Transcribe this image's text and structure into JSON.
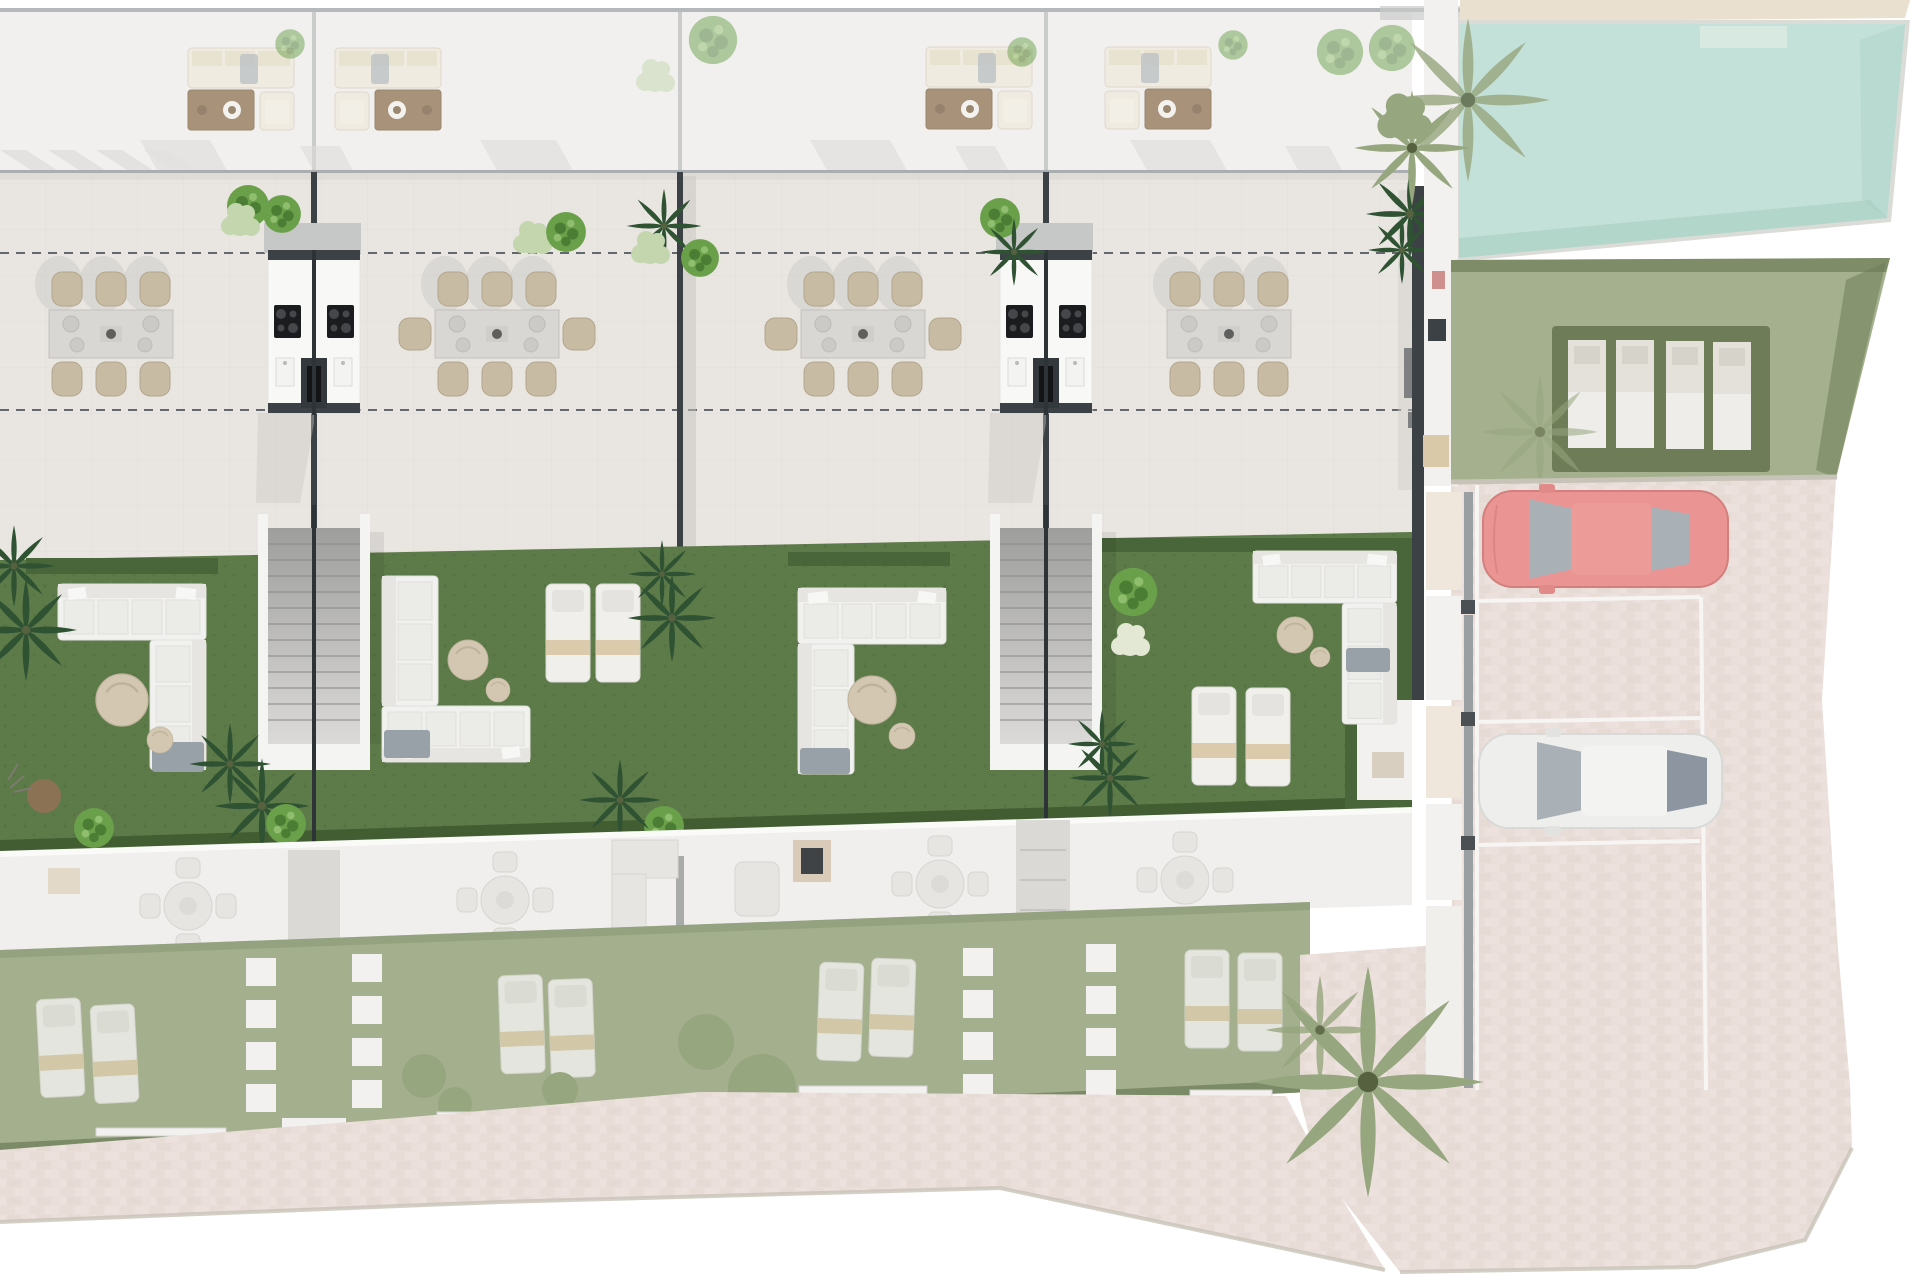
{
  "meta": {
    "title": "Residential development site plan - top view 3D rendering",
    "description": "Top-down architectural rendering of four terraced townhouse units with roof terraces, outdoor kitchens, staircases, private gardens, communal pool, sun-lounger lawn and parking with two cars. Featured floor shown saturated, rest washed out.",
    "visible_text": []
  },
  "colors": {
    "page_bg": "#ffffff",
    "roof_deck": "#f1f0ef",
    "roof_line": "#a8acae",
    "terrace": "#e9e5e1",
    "terrace_grid": "#dcd7d2",
    "dash": "#63686c",
    "wall_dark": "#3c4146",
    "kitchen_white": "#f8f8f7",
    "cooktop": "#1b1c1e",
    "steel": "#c6c7c7",
    "grass": "#5d7a49",
    "grass_dot": "#4e6a3c",
    "hedge": "#49663a",
    "hedge_dark": "#435d33",
    "sofa_white": "#f1f1ef",
    "sofa_trim": "#e0dfdb",
    "cushion": "#ebebe8",
    "throw": "#99a1a8",
    "pouf": "#d3c7b2",
    "pouf_brown": "#8c7254",
    "chair": "#c7bba4",
    "chair_dark": "#b3a68c",
    "table": "#d8d7d4",
    "plate": "#cbcac7",
    "stair_wall": "#f4f4f3",
    "stair_top": "#a3a3a1",
    "stair_bot": "#d9d8d6",
    "tread": "#8b8b89",
    "tree": "#6ba04b",
    "tree_dark": "#4c7d35",
    "tree_light": "#8fbe6e",
    "palm_dark": "#2f5233",
    "bush_light": "#c3d6ae",
    "bush_white": "#e2e8d4",
    "washed_terrace": "#f0efee",
    "washed_path": "#dad9d6",
    "washed_fur": "#e6e5e2",
    "washed_fur_dark": "#d6d5d2",
    "washed_grass": "#a4b08d",
    "washed_hedge": "#7b8a67",
    "washed_white": "#f2f1ef",
    "washed_olive": "#96a67e",
    "paving": "#e9deda",
    "paving_dark": "#dccfc9",
    "curb": "#c8c3b8",
    "pool": "#c3e1d8",
    "pool_steps": "#d8e9e1",
    "pool_shade": "#9fc9bc",
    "lawn": "#a5b18e",
    "lawn_hedge": "#6e7d58",
    "lounger_a": "#e3e1da",
    "lounger_b": "#eeedea",
    "car_red": "#ea9593",
    "car_red_dark": "#d27f7e",
    "car_white": "#eeeeed",
    "car_trim": "#d9d9d8",
    "glass": "#a9b1b6",
    "glass_dark": "#8d96a0",
    "bay_line": "#f6f5f3",
    "sand": "#e9e0cf"
  },
  "scene": {
    "units": [
      {
        "id": "unit-1",
        "roof_lounge_set": true,
        "dining_seats": 6,
        "garden": {
          "corner_sofa": true,
          "poufs": 2,
          "sun_loungers": 0,
          "fire_poufs": 2
        }
      },
      {
        "id": "unit-2",
        "roof_lounge_set": true,
        "dining_seats": 8,
        "garden": {
          "corner_sofa": true,
          "poufs": 2,
          "sun_loungers": 2
        }
      },
      {
        "id": "unit-3",
        "roof_lounge_set": true,
        "dining_seats": 8,
        "garden": {
          "corner_sofa": true,
          "poufs": 2,
          "sun_loungers": 0
        }
      },
      {
        "id": "unit-4",
        "roof_lounge_set": true,
        "dining_seats": 6,
        "garden": {
          "corner_sofa": true,
          "poufs": 2,
          "sun_loungers": 2,
          "topiary_tree": true
        }
      }
    ],
    "shared_features": {
      "outdoor_kitchens": 2,
      "double_staircases": 2,
      "property_dash_lines": 2
    },
    "amenities": {
      "pool": {
        "present": true,
        "tanning_ledge": true
      },
      "lounger_lawn": {
        "sun_loungers": 4
      },
      "parking": {
        "marked_bays": 3,
        "cars": [
          {
            "color_name": "red"
          },
          {
            "color_name": "white"
          }
        ]
      },
      "palm_trees": 3
    },
    "ground_floor_washed": {
      "round_dining_sets": 4,
      "lounger_pairs": 4,
      "garden_gates": 4
    }
  }
}
